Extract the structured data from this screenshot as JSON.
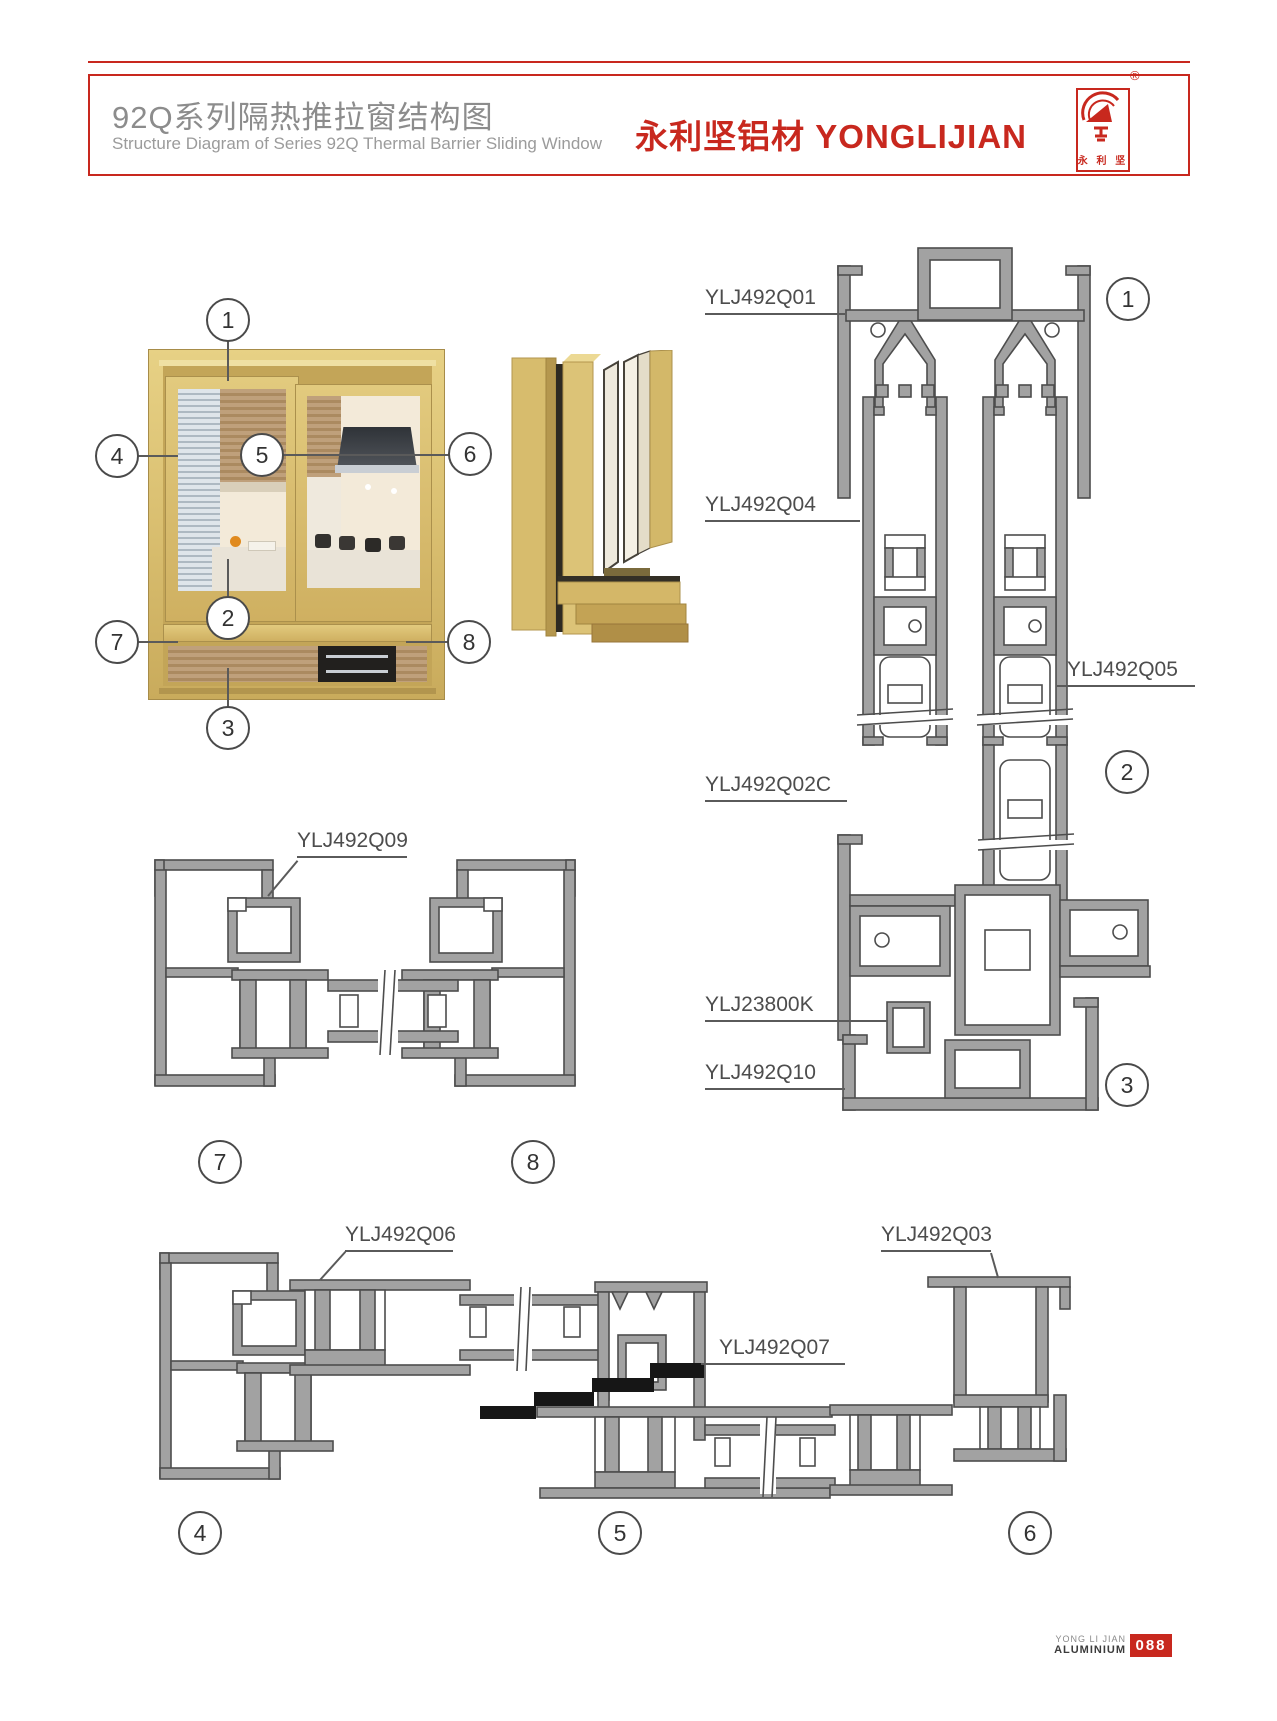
{
  "header": {
    "title_cn": "92Q系列隔热推拉窗结构图",
    "title_en": "Structure Diagram of Series 92Q Thermal Barrier Sliding Window",
    "brand_cn": "永利坚铝材",
    "brand_en": "YONGLIJIAN",
    "registered_mark": "®",
    "logo_text": "永 利 坚",
    "accent_color": "#c8281e"
  },
  "labels": {
    "q01": "YLJ492Q01",
    "q04": "YLJ492Q04",
    "q05": "YLJ492Q05",
    "q02c": "YLJ492Q02C",
    "k23800": "YLJ23800K",
    "q10": "YLJ492Q10",
    "q09": "YLJ492Q09",
    "q06": "YLJ492Q06",
    "q03": "YLJ492Q03",
    "q07": "YLJ492Q07"
  },
  "callouts": {
    "c1": "1",
    "c2": "2",
    "c3": "3",
    "c4": "4",
    "c5": "5",
    "c6": "6",
    "c7": "7",
    "c8": "8"
  },
  "diagrams": {
    "vertical_section_callouts": [
      "1",
      "2",
      "3"
    ],
    "mid_horizontal_callouts": [
      "7",
      "8"
    ],
    "bottom_horizontal_callouts": [
      "4",
      "5",
      "6"
    ]
  },
  "footer": {
    "brand_line1": "YONG LI JIAN",
    "brand_line2": "ALUMINIUM",
    "page_number": "088"
  },
  "colors": {
    "accent_red": "#c8281e",
    "profile_gray": "#a2a2a2",
    "line_gray": "#4d4d4d",
    "frame_gold": "#d8bd6e"
  }
}
